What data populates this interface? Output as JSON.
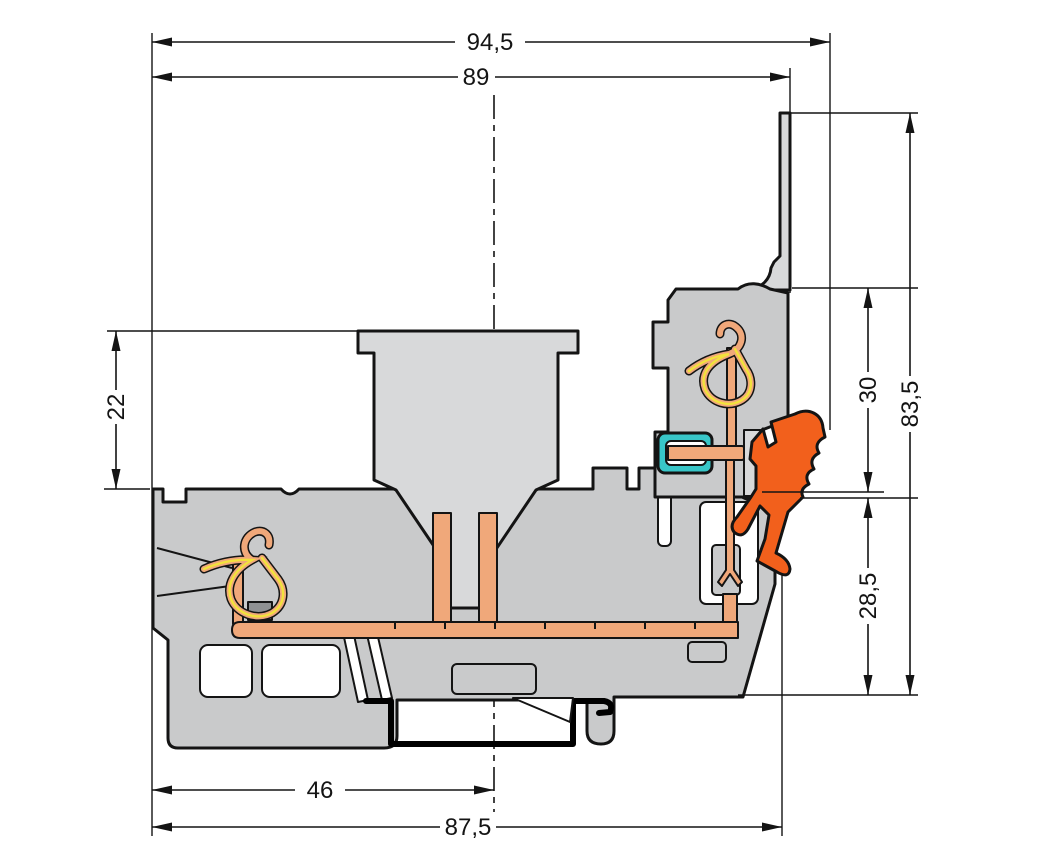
{
  "drawing": {
    "type": "dimensioned-cross-section",
    "subject": "rail-mount terminal block side view",
    "dimensions": {
      "overall_width": "94,5",
      "flange_width": "89",
      "actuator_height": "22",
      "upper_height": "30",
      "total_height": "83,5",
      "lower_height": "28,5",
      "base_width": "46",
      "housing_width": "87,5"
    },
    "colors": {
      "background": "#ffffff",
      "outline": "#141414",
      "housing": "#c9cacb",
      "light_part": "#d8d9da",
      "busbar": "#f0a87a",
      "spring": "#f2e23c",
      "socket": "#38c6c8",
      "lever": "#f2601c"
    },
    "parts": [
      "housing",
      "din-rail",
      "busbar",
      "clamping-spring-left",
      "clamping-spring-right",
      "jumper-socket",
      "locking-lever",
      "marker-flange",
      "actuator-funnel",
      "center-line"
    ]
  }
}
